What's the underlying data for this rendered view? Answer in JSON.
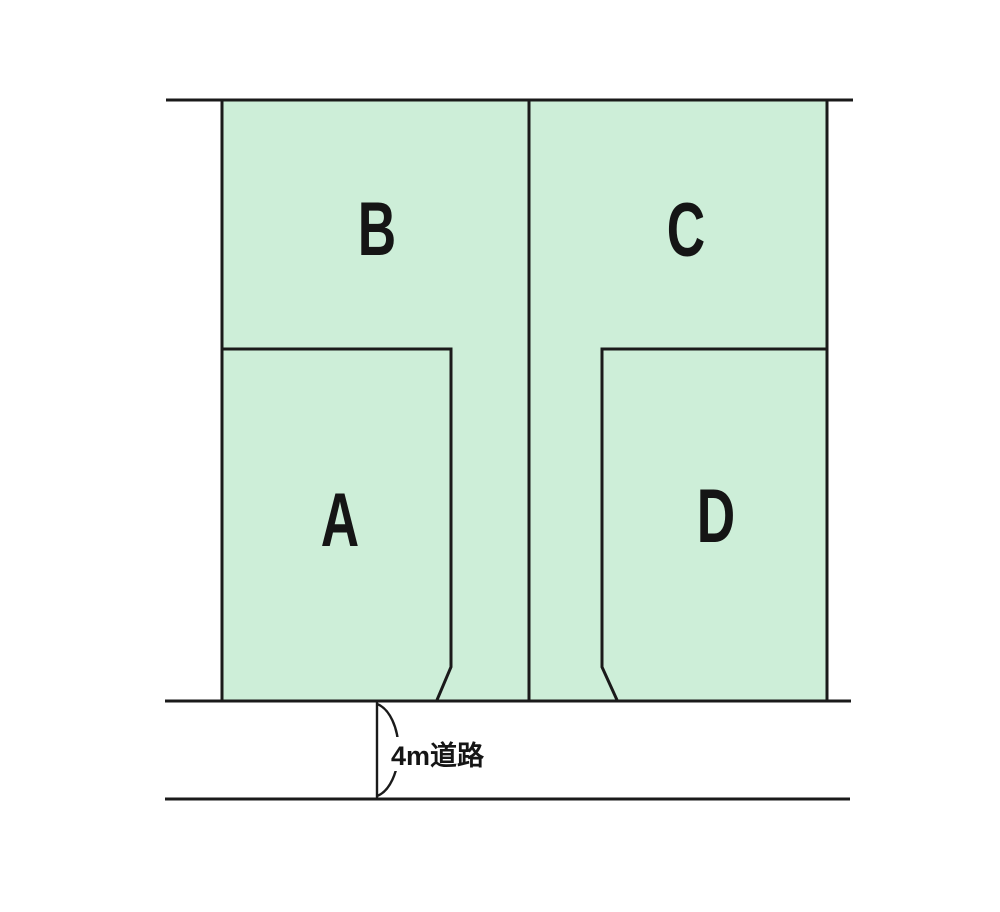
{
  "diagram": {
    "plots": [
      {
        "label": "B"
      },
      {
        "label": "C"
      },
      {
        "label": "A"
      },
      {
        "label": "D"
      }
    ],
    "road": {
      "label": "4m道路"
    },
    "colors": {
      "plot_fill": "#cdeed8",
      "line": "#1a1a1a",
      "label_text": "#151515",
      "background": "#ffffff"
    }
  }
}
